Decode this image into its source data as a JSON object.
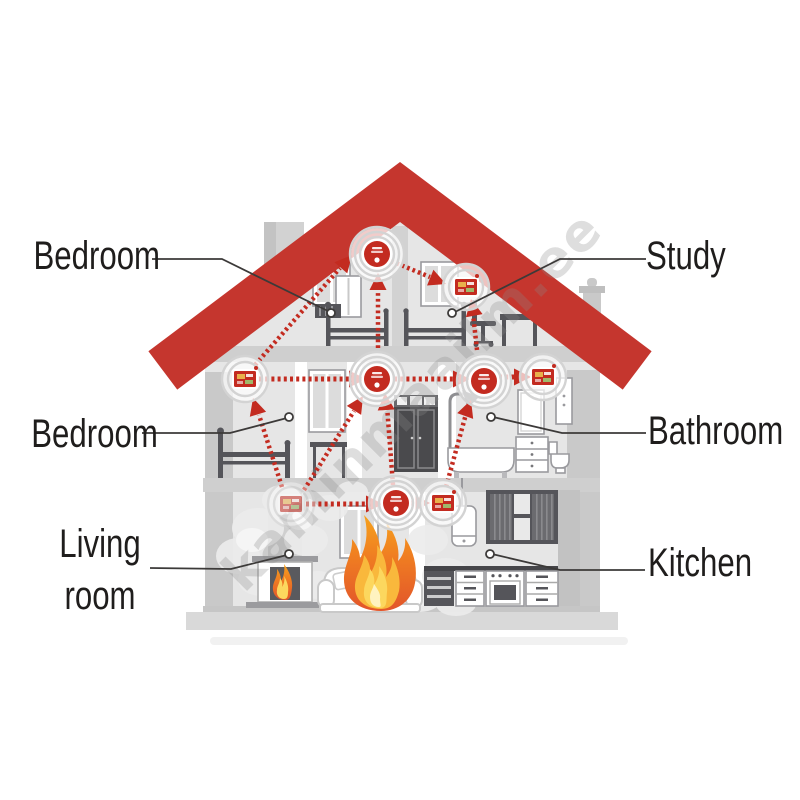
{
  "title": "Interconnected fire alarm system in a house cutaway",
  "watermark": {
    "text": "kaminmaailm.ee"
  },
  "rooms": [
    {
      "id": "bedroom-attic",
      "label": "Bedroom",
      "side": "left"
    },
    {
      "id": "study",
      "label": "Study",
      "side": "right"
    },
    {
      "id": "bedroom-second-floor",
      "label": "Bedroom",
      "side": "left"
    },
    {
      "id": "bathroom",
      "label": "Bathroom",
      "side": "right"
    },
    {
      "id": "living-room",
      "label": "Living room",
      "lines": [
        "Living",
        "room"
      ],
      "side": "left"
    },
    {
      "id": "kitchen",
      "label": "Kitchen",
      "side": "right"
    }
  ],
  "devices": {
    "ceiling_smoke_detectors": 4,
    "wall_alarm_panels": 5,
    "signal_arrows": 13,
    "fire_locations": [
      "sofa-living-room",
      "fireplace"
    ]
  },
  "icons": [
    "smoke-detector-icon",
    "alarm-panel-icon",
    "signal-arrow-icon",
    "flame-icon",
    "smoke-cloud-icon",
    "leader-dot-icon"
  ],
  "colors": {
    "roof_red": "#c5362e",
    "alarm_red": "#c32b20",
    "label_text": "#1f1d1c",
    "wall_light": "#e6e6e6",
    "slab_gray": "#cfcfcf",
    "exterior_wall": "#c9c9c9",
    "furniture_dark": "#55555a",
    "smoke_gray": "#ececec",
    "leader_line": "#3c3a39",
    "flame_red": "#e2552a",
    "flame_orange": "#f6a21c",
    "flame_yellow": "#fcd75e"
  }
}
